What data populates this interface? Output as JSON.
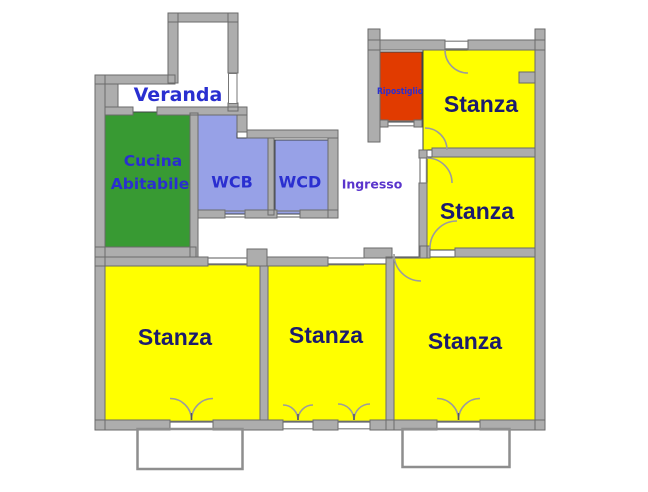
{
  "rooms": {
    "veranda": {
      "label": "Veranda"
    },
    "cucina": {
      "line1": "Cucina",
      "line2": "Abitabile",
      "fill": "#389A33"
    },
    "wcb": {
      "label": "WCB",
      "fill": "#97A1E7"
    },
    "wcd": {
      "label": "WCD",
      "fill": "#97A1E7"
    },
    "ingresso": {
      "label": "Ingresso"
    },
    "ripostiglio": {
      "label": "Ripostiglio",
      "fill": "#E13B00"
    },
    "stanze": [
      {
        "id": "top-right",
        "label": "Stanza",
        "fill": "#FFFF00"
      },
      {
        "id": "middle-right",
        "label": "Stanza",
        "fill": "#FFFF00"
      },
      {
        "id": "bottom-left",
        "label": "Stanza",
        "fill": "#FFFF00"
      },
      {
        "id": "bottom-center",
        "label": "Stanza",
        "fill": "#FFFF00"
      },
      {
        "id": "bottom-right",
        "label": "Stanza",
        "fill": "#FFFF00"
      }
    ]
  },
  "colors": {
    "wall": "#ADADAD",
    "wall_outline": "#6A6A6A",
    "label_blue": "#2A2FD0",
    "label_purple": "#5A35CC",
    "stanza_navy": "#1B1B6E",
    "door_arc": "#9C9C9C",
    "background": "#FFFFFF"
  }
}
